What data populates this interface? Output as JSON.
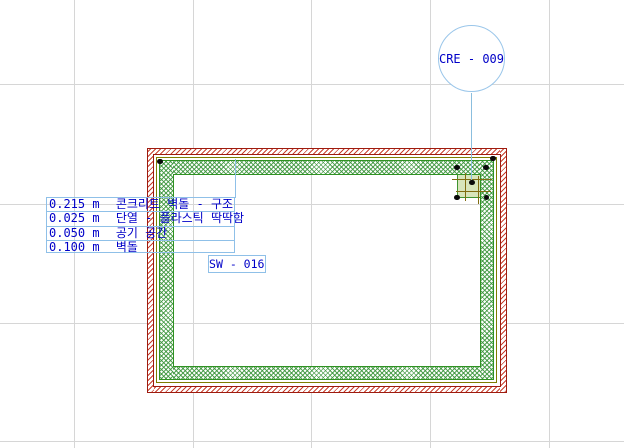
{
  "drawing": {
    "type": "cad-floor-plan-wall-detail",
    "column_callout": {
      "label": "CRE - 009"
    },
    "wall_tag": {
      "label": "SW - 016"
    },
    "wall_composite_label": {
      "rows": [
        {
          "thickness": "0.215 m",
          "material": "콘크리트 벽돌 - 구조"
        },
        {
          "thickness": "0.025 m",
          "material": "단열 - 플라스틱 딱딱함"
        },
        {
          "thickness": "0.050 m",
          "material": "공기 공간"
        },
        {
          "thickness": "0.100 m",
          "material": "벽돌"
        }
      ]
    },
    "colors": {
      "annotation_text": "#0000c8",
      "annotation_frame": "#8fc0e8",
      "wall_outline_red": "#9e1b0f",
      "brick_hatch_red": "#c8402e",
      "insulation_olive": "#7d7d00",
      "concrete_green": "#2f9222",
      "column_core_olive": "#806c10",
      "column_fill": "#d7e5bb",
      "selection_handle": "#0a0a0a",
      "grid": "#d6d6d6",
      "background": "#ffffff"
    }
  }
}
